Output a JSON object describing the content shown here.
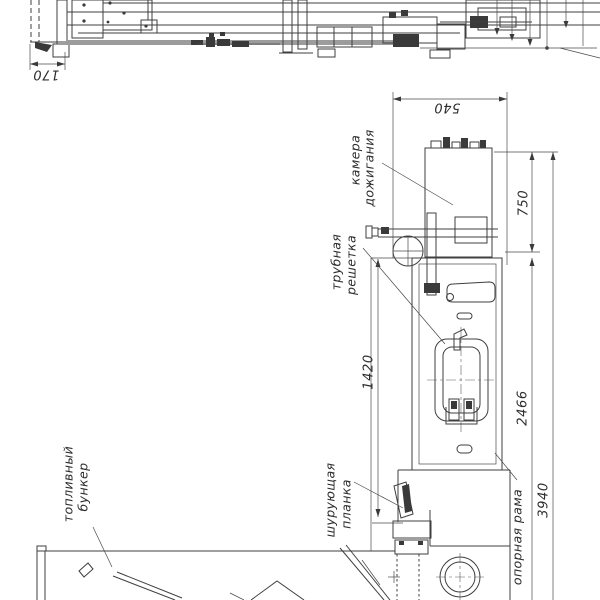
{
  "page": {
    "background": "#ffffff",
    "ink": "#3f3f3f"
  },
  "drawing": {
    "kind": "boiler-assembly-technical-drawing",
    "labels": {
      "combustion_chamber_line1": "камера",
      "combustion_chamber_line2": "дожигания",
      "tube_grate_line1": "трубная",
      "tube_grate_line2": "решетка",
      "fuel_bunker_line1": "топливный",
      "fuel_bunker_line2": "бункер",
      "stoker_bar_line1": "шурующая",
      "stoker_bar_line2": "планка",
      "support_frame": "опорная рама"
    },
    "dimensions": {
      "bunker_width": "170",
      "chamber_width": "540",
      "chamber_height": "750",
      "grate_length": "1420",
      "frame_height": "2466",
      "total_height": "3940"
    }
  }
}
